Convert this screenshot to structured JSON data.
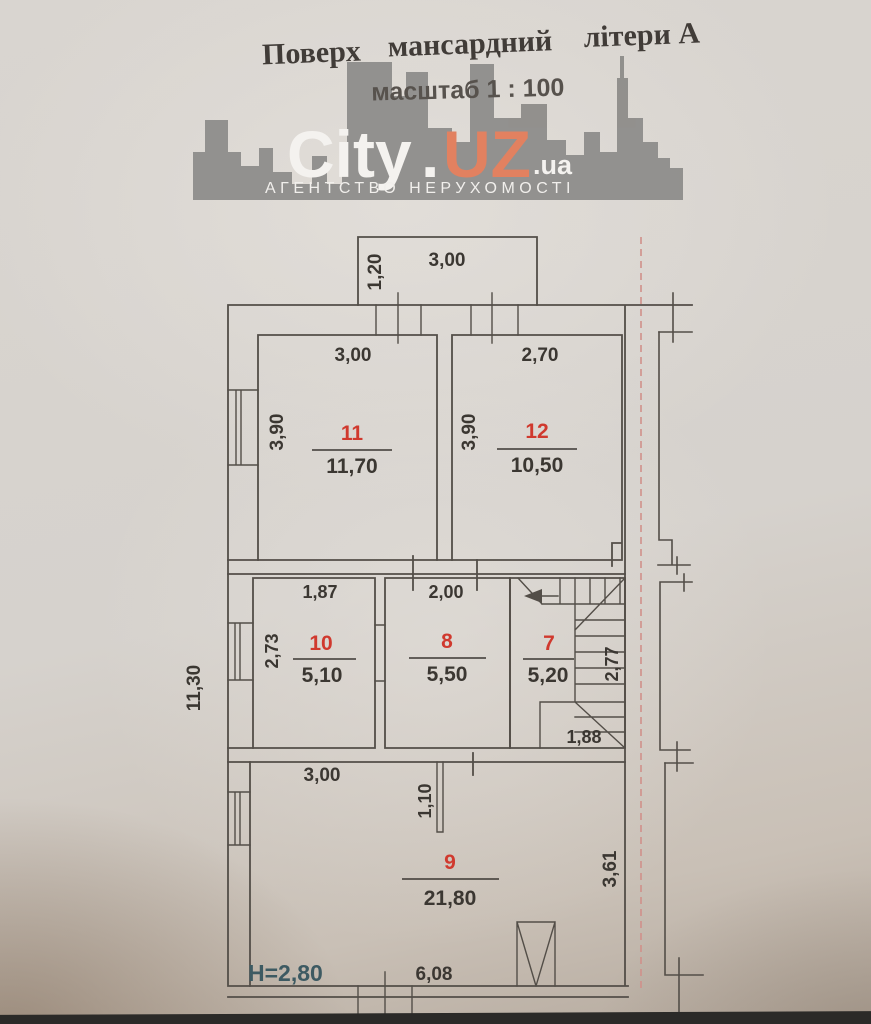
{
  "header": {
    "words": [
      "Поверх",
      "мансардний",
      "літери А"
    ],
    "scale": "масштаб 1 : 100"
  },
  "logo": {
    "city": "City",
    "dot": ".",
    "uz": "UZ",
    "ua": ".ua",
    "tagline": "АГЕНТСТВО  НЕРУХОМОСТІ",
    "accent_color": "#e28160",
    "silhouette_color": "#8f8e8b",
    "text_color": "#f4f2ef"
  },
  "rooms": {
    "r11": {
      "num": "11",
      "area": "11,70",
      "w": "3,00",
      "h": "3,90"
    },
    "r12": {
      "num": "12",
      "area": "10,50",
      "w": "2,70",
      "h": "3,90"
    },
    "r10": {
      "num": "10",
      "area": "5,10",
      "w": "1,87",
      "h": "2,73"
    },
    "r8": {
      "num": "8",
      "area": "5,50",
      "w": "2,00"
    },
    "r7": {
      "num": "7",
      "area": "5,20",
      "d1": "2,77",
      "d2": "1,88"
    },
    "r9": {
      "num": "9",
      "area": "21,80",
      "w": "3,00",
      "niche": "1,10",
      "right": "3,61",
      "bottom": "6,08"
    }
  },
  "dims": {
    "balcony_w": "3,00",
    "balcony_d": "1,20",
    "overall": "11,30",
    "height_note": "H=2,80"
  },
  "colors": {
    "plan_line": "#534e48",
    "room_number": "#d0392e",
    "dim_text": "#3b3732",
    "height_note": "#3d5a62",
    "section_line": "#d0908a",
    "paper": "#d6d2cd",
    "photo_edge": "#2b2a28"
  }
}
